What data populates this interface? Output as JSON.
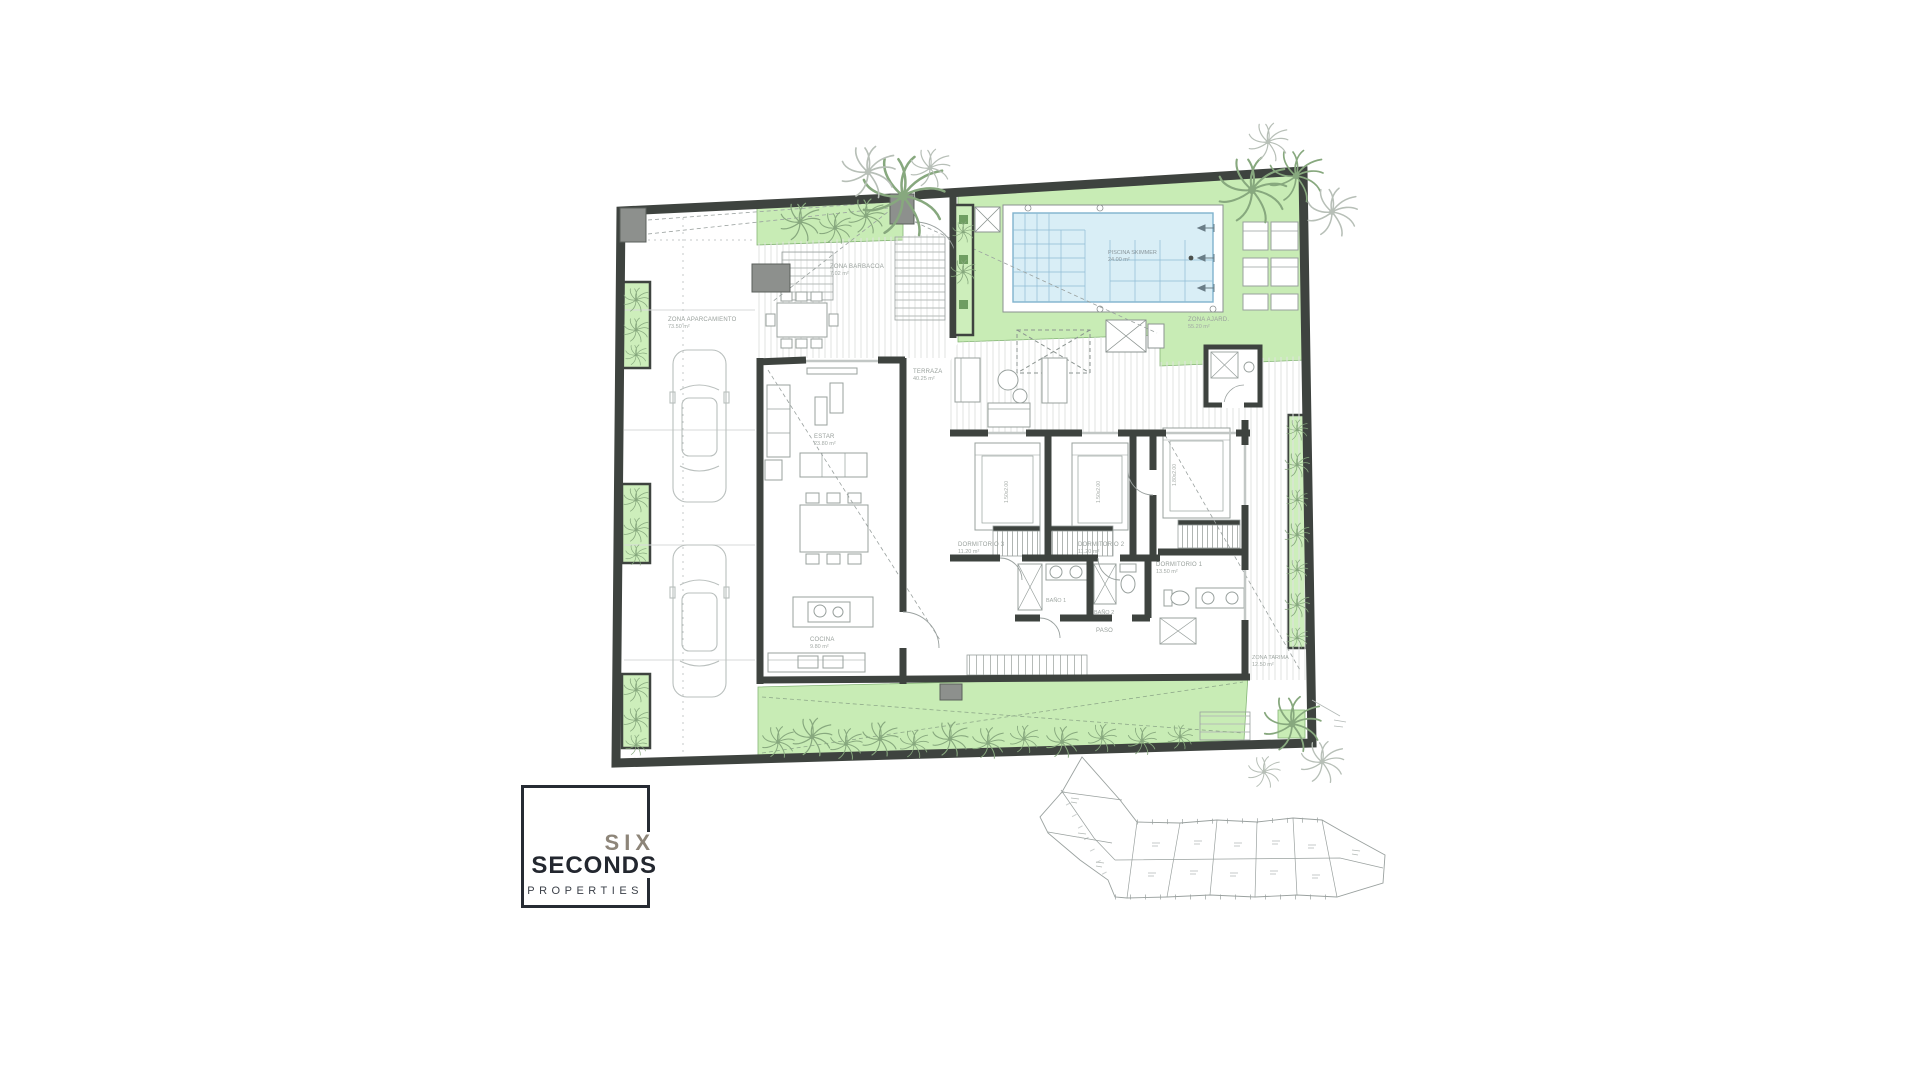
{
  "logo": {
    "six": "SIX",
    "seconds": "SECONDS",
    "properties": "PROPERTIES",
    "accent_color": "#8d8579",
    "dark_color": "#23272f"
  },
  "plan": {
    "colors": {
      "wall": "#3e433f",
      "garden_green": "#c8ecb5",
      "garden_border": "#86b577",
      "pool_water": "#d9eef6",
      "pool_edge": "#7fb2cd",
      "deck_stripe": "#e0e3e0",
      "pillar_gray": "#8d908d",
      "palm_green": "#87a87e",
      "palm_gray": "#b7bfb7",
      "label_gray": "#99a09c"
    },
    "labels": {
      "parking": {
        "l1": "ZONA APARCAMIENTO",
        "l2": "73.50 m²"
      },
      "barbacoa": {
        "l1": "ZONA BARBACOA",
        "l2": "7.02 m²"
      },
      "piscina": {
        "l1": "PISCINA SKIMMER",
        "l2": "24.00 m²"
      },
      "ajardinada": {
        "l1": "ZONA AJARD.",
        "l2": "55.20 m²"
      },
      "terraza": {
        "l1": "TERRAZA",
        "l2": "40.25 m²"
      },
      "estar": {
        "l1": "ESTAR",
        "l2": "23.80 m²"
      },
      "cocina": {
        "l1": "COCINA",
        "l2": "9.80 m²"
      },
      "dorm3": {
        "l1": "DORMITORIO 3",
        "l2": "11.20 m²"
      },
      "dorm2": {
        "l1": "DORMITORIO 2",
        "l2": "11.20 m²"
      },
      "dorm1": {
        "l1": "DORMITORIO 1",
        "l2": "13.50 m²"
      },
      "bano1": {
        "l1": "BAÑO 1",
        "l2": "4.10 m²"
      },
      "bano2": {
        "l1": "BAÑO 2",
        "l2": "4.10 m²"
      },
      "paso": {
        "l1": "PASO",
        "l2": "6.00 m²"
      },
      "tarima": {
        "l1": "ZONA TARIMA",
        "l2": "12.50 m²"
      },
      "bed_size_double": "1.50x2.00",
      "bed_size_master": "1.80x2.00"
    }
  }
}
